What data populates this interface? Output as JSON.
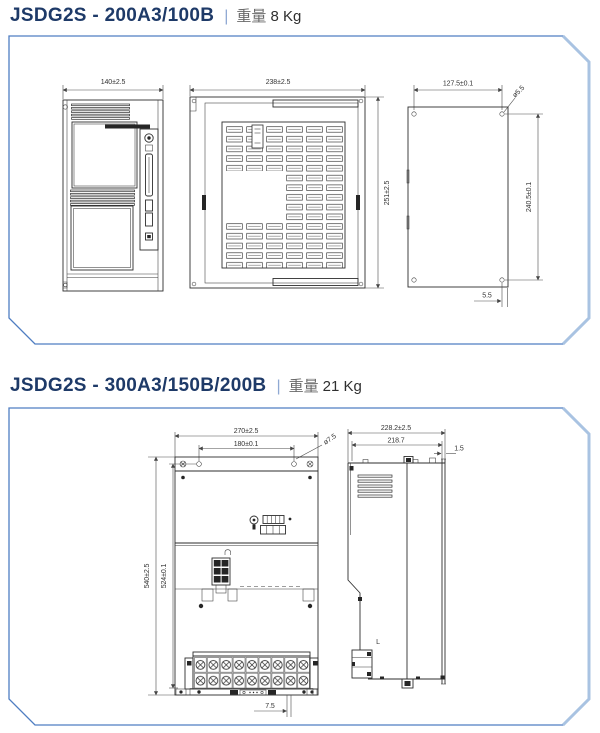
{
  "colors": {
    "panel_border": "#4f7ec2",
    "panel_border_light": "#a9c3e2",
    "title": "#1e3a68",
    "separator": "#8fa9d3",
    "weight_label": "#6a6a6a",
    "weight_value": "#2f2f2f",
    "drawing_line": "#2e2e2e"
  },
  "s1": {
    "model": "JSDG2S - 200A3/100B",
    "sep": "|",
    "weight_label": "重量",
    "weight": "8 Kg",
    "front": {
      "w": "140±2.5"
    },
    "side": {
      "w": "238±2.5",
      "h": "251±2.5"
    },
    "back": {
      "w": "127.5±0.1",
      "h": "240.5±0.1",
      "hole": "ø5.5",
      "edge": "5.5"
    }
  },
  "s2": {
    "model": "JSDG2S - 300A3/150B/200B",
    "sep": "|",
    "weight_label": "重量",
    "weight": "21 Kg",
    "front": {
      "w": "270±2.5",
      "holes_w": "180±0.1",
      "hole": "ø7.5",
      "h": "540±2.5",
      "holes_h": "524±0.1",
      "edge": "7.5"
    },
    "side": {
      "d": "228.2±2.5",
      "body_d": "218.7",
      "plate_t": "1.5",
      "label": "L"
    }
  }
}
